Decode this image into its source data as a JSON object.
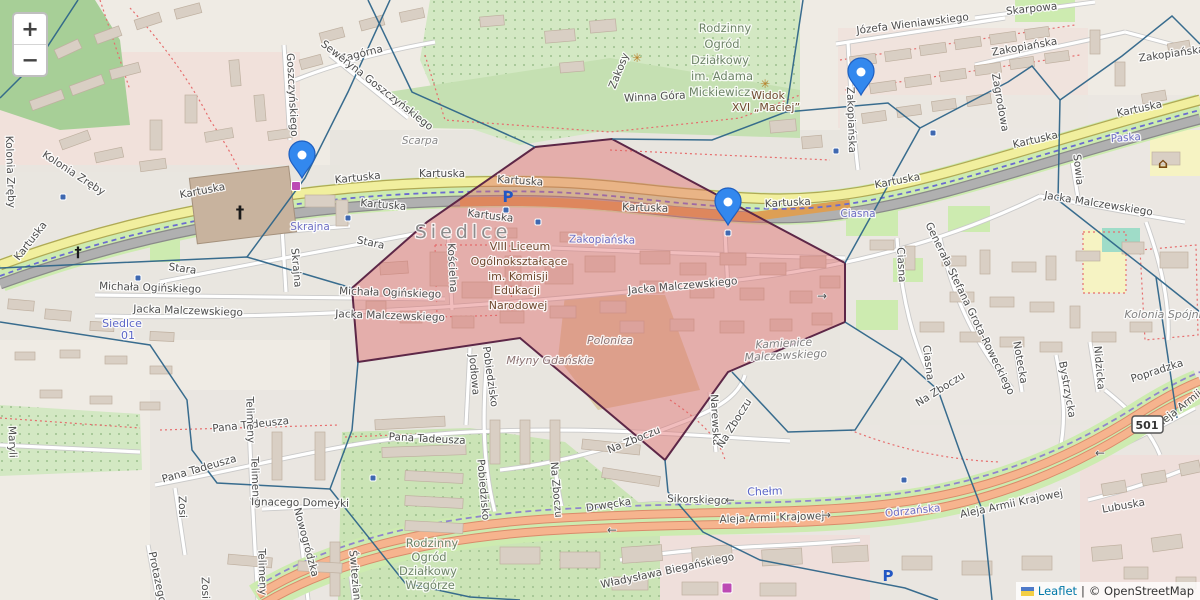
{
  "controls": {
    "zoom_in": "+",
    "zoom_out": "−"
  },
  "attribution": {
    "leaflet_label": "Leaflet",
    "separator": "|",
    "osm_label": "© OpenStreetMap"
  },
  "shield": {
    "text": "501",
    "x": 1147,
    "y": 424
  },
  "colors": {
    "zone_fill": "#df6868",
    "zone_stroke": "#5d2747",
    "boundary_blue": "#2e6589",
    "marker_blue": "#3388ee",
    "marker_border": "#1f5fc0",
    "tram_dash": "#6b6bd0",
    "road_yellow": "#f1ef9e",
    "trunk_orange": "#f6b48e",
    "green_verge": "#cdebb0"
  },
  "markers": [
    {
      "x": 302,
      "y": 178
    },
    {
      "x": 728,
      "y": 225
    },
    {
      "x": 861,
      "y": 95
    }
  ],
  "labels": [
    [
      "Kartuska",
      33,
      243,
      -52,
      "st"
    ],
    [
      "Kartuska",
      203,
      194,
      -11,
      "st"
    ],
    [
      "Kartuska",
      358,
      181,
      -6,
      "st"
    ],
    [
      "Kartuska",
      442,
      177,
      0,
      "st"
    ],
    [
      "Kartuska",
      520,
      184,
      4,
      "st"
    ],
    [
      "Kartuska",
      383,
      208,
      5,
      "st"
    ],
    [
      "Kartuska",
      490,
      219,
      7,
      "st"
    ],
    [
      "Kartuska",
      645,
      211,
      2,
      "st"
    ],
    [
      "Kartuska",
      788,
      206,
      -3,
      "st"
    ],
    [
      "Kartuska",
      898,
      184,
      -11,
      "st"
    ],
    [
      "Kartuska",
      1036,
      143,
      -13,
      "st"
    ],
    [
      "Kartuska",
      1140,
      112,
      -12,
      "st"
    ],
    [
      "Zagórna",
      362,
      57,
      -14,
      "st"
    ],
    [
      "Skarpowa",
      1032,
      12,
      -6,
      "st"
    ],
    [
      "Józefa Wieniawskiego",
      913,
      27,
      -7,
      "st"
    ],
    [
      "Winna Góra",
      655,
      100,
      -3,
      "st"
    ],
    [
      "Zakosy",
      622,
      72,
      -68,
      "st"
    ],
    [
      "Scarpa",
      420,
      144,
      0,
      "lo"
    ],
    [
      "Goszczyńskiego",
      289,
      95,
      87,
      "st"
    ],
    [
      "Seweryna Goszczyńskiego",
      375,
      88,
      38,
      "st"
    ],
    [
      "Kolonia Zręby",
      72,
      176,
      33,
      "st"
    ],
    [
      "Kolonia Zręby",
      7,
      172,
      88,
      "st"
    ],
    [
      "Stara",
      182,
      272,
      8,
      "st"
    ],
    [
      "Stara",
      370,
      246,
      12,
      "st"
    ],
    [
      "Skrajna",
      310,
      230,
      0,
      "pu"
    ],
    [
      "Skrajna",
      293,
      268,
      85,
      "st"
    ],
    [
      "Michała Ogińskiego",
      150,
      291,
      2,
      "st"
    ],
    [
      "Michała Ogińskiego",
      390,
      296,
      2,
      "st"
    ],
    [
      "Jacka Malczewskiego",
      188,
      314,
      2,
      "st"
    ],
    [
      "Jacka Malczewskiego",
      390,
      319,
      2,
      "st"
    ],
    [
      "Jacka Malczewskiego",
      683,
      289,
      -5,
      "st"
    ],
    [
      "Jacka Malczewskiego",
      1098,
      207,
      9,
      "st"
    ],
    [
      "Kościelna",
      449,
      268,
      87,
      "st"
    ],
    [
      "Zakopiańska",
      602,
      243,
      1,
      "pu"
    ],
    [
      "Zakopiańska",
      848,
      120,
      88,
      "st"
    ],
    [
      "Zakopiańska",
      1025,
      50,
      -10,
      "st"
    ],
    [
      "Zakopiańska",
      1172,
      57,
      -8,
      "st"
    ],
    [
      "Zagrodowa",
      997,
      103,
      80,
      "st"
    ],
    [
      "Sowia",
      1075,
      170,
      84,
      "st"
    ],
    [
      "Paska",
      1126,
      141,
      -4,
      "pu"
    ],
    [
      "Ciasna",
      858,
      217,
      0,
      "pu"
    ],
    [
      "Ciasna",
      898,
      265,
      87,
      "st"
    ],
    [
      "Ciasna",
      925,
      363,
      83,
      "st"
    ],
    [
      "Generała Stefana Grota-Roweckiego",
      967,
      310,
      64,
      "st"
    ],
    [
      "Notecka",
      1017,
      363,
      80,
      "st"
    ],
    [
      "Bystrzycka",
      1064,
      390,
      80,
      "st"
    ],
    [
      "Nidzicka",
      1096,
      368,
      85,
      "st"
    ],
    [
      "Popradzka",
      1158,
      374,
      -18,
      "st"
    ],
    [
      "Na Zboczu",
      942,
      392,
      -32,
      "st"
    ],
    [
      "Na Zboczu",
      635,
      443,
      -22,
      "st"
    ],
    [
      "Na Zboczu",
      553,
      490,
      85,
      "st"
    ],
    [
      "Narewska",
      712,
      420,
      87,
      "st"
    ],
    [
      "Na Zboczu",
      737,
      425,
      -58,
      "st"
    ],
    [
      "Jodłowa",
      471,
      375,
      85,
      "st"
    ],
    [
      "Pobiedzisko",
      487,
      377,
      82,
      "st"
    ],
    [
      "Pobiedzisko",
      480,
      490,
      85,
      "st"
    ],
    [
      "Pana Tadeusza",
      251,
      428,
      -6,
      "st"
    ],
    [
      "Pana Tadeusza",
      200,
      472,
      -16,
      "st"
    ],
    [
      "Pana Tadeusza",
      427,
      442,
      3,
      "st"
    ],
    [
      "Telimeny",
      247,
      420,
      88,
      "st"
    ],
    [
      "Telimeny",
      252,
      480,
      88,
      "st"
    ],
    [
      "Telimeny",
      259,
      572,
      88,
      "st"
    ],
    [
      "Ignacego Domeyki",
      300,
      506,
      1,
      "st"
    ],
    [
      "Nowogródzka",
      303,
      543,
      75,
      "st"
    ],
    [
      "Zosi",
      179,
      507,
      88,
      "st"
    ],
    [
      "Zosi",
      202,
      588,
      88,
      "st"
    ],
    [
      "Protazego",
      154,
      578,
      78,
      "st"
    ],
    [
      "Świtezianki",
      352,
      580,
      85,
      "st"
    ],
    [
      "Maryli",
      9,
      442,
      88,
      "st"
    ],
    [
      "Drwęcka",
      609,
      508,
      -9,
      "st"
    ],
    [
      "Sikorskiego",
      697,
      503,
      2,
      "st"
    ],
    [
      "Aleja Armii Krajowej",
      772,
      521,
      -2,
      "st"
    ],
    [
      "Odrzańska",
      913,
      514,
      -6,
      "pu"
    ],
    [
      "Aleja Armii Krajowej",
      1012,
      507,
      -12,
      "st"
    ],
    [
      "Aleja Armii",
      1180,
      412,
      -38,
      "st"
    ],
    [
      "Lubuska",
      1124,
      509,
      -10,
      "st"
    ],
    [
      "Władysława Biegańskiego",
      668,
      574,
      -12,
      "st"
    ],
    [
      "Chełm",
      765,
      495,
      -2,
      "tr"
    ],
    [
      "Siedlce",
      463,
      238,
      0,
      "big"
    ],
    [
      "Polonica",
      610,
      344,
      0,
      "ar"
    ],
    [
      "Młyny Gdańskie",
      550,
      364,
      0,
      "ar"
    ],
    [
      "Kamienice",
      784,
      347,
      -3,
      "ar2"
    ],
    [
      "Malczewskiego",
      786,
      359,
      -3,
      "ar2"
    ],
    [
      "Kolonia Spójni",
      1163,
      318,
      0,
      "ar2"
    ],
    [
      "Rodzinny",
      725,
      32,
      0,
      "gr"
    ],
    [
      "Ogród",
      722,
      48,
      0,
      "gr"
    ],
    [
      "Działkowy",
      720,
      64,
      0,
      "gr"
    ],
    [
      "im. Adama",
      722,
      80,
      0,
      "gr"
    ],
    [
      "Mickiewicza",
      723,
      96,
      0,
      "gr"
    ],
    [
      "Rodzinny",
      432,
      547,
      0,
      "gr"
    ],
    [
      "Ogród",
      429,
      561,
      0,
      "gr"
    ],
    [
      "Działkowy",
      428,
      575,
      0,
      "gr"
    ],
    [
      "Wzgórze",
      430,
      589,
      0,
      "gr"
    ],
    [
      "Widok",
      768,
      99,
      0,
      "br"
    ],
    [
      "XVI „Maciej”",
      766,
      111,
      0,
      "br"
    ],
    [
      "VIII Liceum",
      520,
      250,
      0,
      "br"
    ],
    [
      "Ogólnokształcące",
      519,
      265,
      0,
      "br"
    ],
    [
      "im. Komisji",
      518,
      280,
      0,
      "br"
    ],
    [
      "Edukacji",
      517,
      294,
      0,
      "br"
    ],
    [
      "Narodowej",
      518,
      309,
      0,
      "br"
    ],
    [
      "Siedlce",
      122,
      327,
      0,
      "tr"
    ],
    [
      "01",
      128,
      339,
      0,
      "tr"
    ],
    [
      "←",
      730,
      504,
      0,
      "arw"
    ],
    [
      "→",
      826,
      519,
      0,
      "arw"
    ],
    [
      "←",
      612,
      534,
      0,
      "arw"
    ],
    [
      "←",
      1100,
      457,
      0,
      "arw"
    ],
    [
      "→",
      822,
      300,
      0,
      "arw"
    ]
  ],
  "icons": [
    {
      "t": "glyph",
      "g": "†",
      "x": 240,
      "y": 218,
      "c": "#1a1a1a",
      "s": 17,
      "b": 1,
      "n": "church-cross-icon"
    },
    {
      "t": "glyph",
      "g": "†",
      "x": 78,
      "y": 257,
      "c": "#1a1a1a",
      "s": 14,
      "b": 1,
      "n": "church-cross-icon"
    },
    {
      "t": "glyph",
      "g": "P",
      "x": 508,
      "y": 202,
      "c": "#2257c4",
      "s": 15,
      "b": 1,
      "n": "parking-icon"
    },
    {
      "t": "glyph",
      "g": "P",
      "x": 888,
      "y": 581,
      "c": "#2257c4",
      "s": 15,
      "b": 1,
      "n": "parking-icon"
    },
    {
      "t": "glyph",
      "g": "✳",
      "x": 637,
      "y": 62,
      "c": "#b8802a",
      "s": 12,
      "b": 0,
      "n": "flower-icon"
    },
    {
      "t": "glyph",
      "g": "✳",
      "x": 765,
      "y": 88,
      "c": "#b8802a",
      "s": 12,
      "b": 0,
      "n": "flower-icon"
    },
    {
      "t": "glyph",
      "g": "⌂",
      "x": 1163,
      "y": 168,
      "c": "#7a4a12",
      "s": 14,
      "b": 1,
      "n": "school-icon"
    },
    {
      "t": "sq",
      "x": 296,
      "y": 186,
      "c": "#bc4ab4",
      "s": 9,
      "n": "shop-icon"
    },
    {
      "t": "sq",
      "x": 727,
      "y": 588,
      "c": "#bc4ab4",
      "s": 10,
      "n": "shopping-cart-icon"
    },
    {
      "t": "sq",
      "x": 63,
      "y": 197,
      "c": "#3f68b0",
      "s": 6,
      "n": "tram-stop-icon"
    },
    {
      "t": "sq",
      "x": 348,
      "y": 218,
      "c": "#3f68b0",
      "s": 6,
      "n": "tram-stop-icon"
    },
    {
      "t": "sq",
      "x": 506,
      "y": 210,
      "c": "#3f68b0",
      "s": 6,
      "n": "tram-stop-icon"
    },
    {
      "t": "sq",
      "x": 538,
      "y": 222,
      "c": "#3f68b0",
      "s": 6,
      "n": "tram-stop-icon"
    },
    {
      "t": "sq",
      "x": 728,
      "y": 233,
      "c": "#3f68b0",
      "s": 6,
      "n": "tram-stop-icon"
    },
    {
      "t": "sq",
      "x": 836,
      "y": 151,
      "c": "#3f68b0",
      "s": 6,
      "n": "tram-stop-icon"
    },
    {
      "t": "sq",
      "x": 933,
      "y": 133,
      "c": "#3f68b0",
      "s": 6,
      "n": "tram-stop-icon"
    },
    {
      "t": "sq",
      "x": 373,
      "y": 478,
      "c": "#3f68b0",
      "s": 6,
      "n": "bus-stop-icon"
    },
    {
      "t": "sq",
      "x": 904,
      "y": 480,
      "c": "#3f68b0",
      "s": 6,
      "n": "bus-stop-icon"
    },
    {
      "t": "sq",
      "x": 138,
      "y": 278,
      "c": "#3f68b0",
      "s": 6,
      "n": "tram-stop-icon"
    }
  ]
}
